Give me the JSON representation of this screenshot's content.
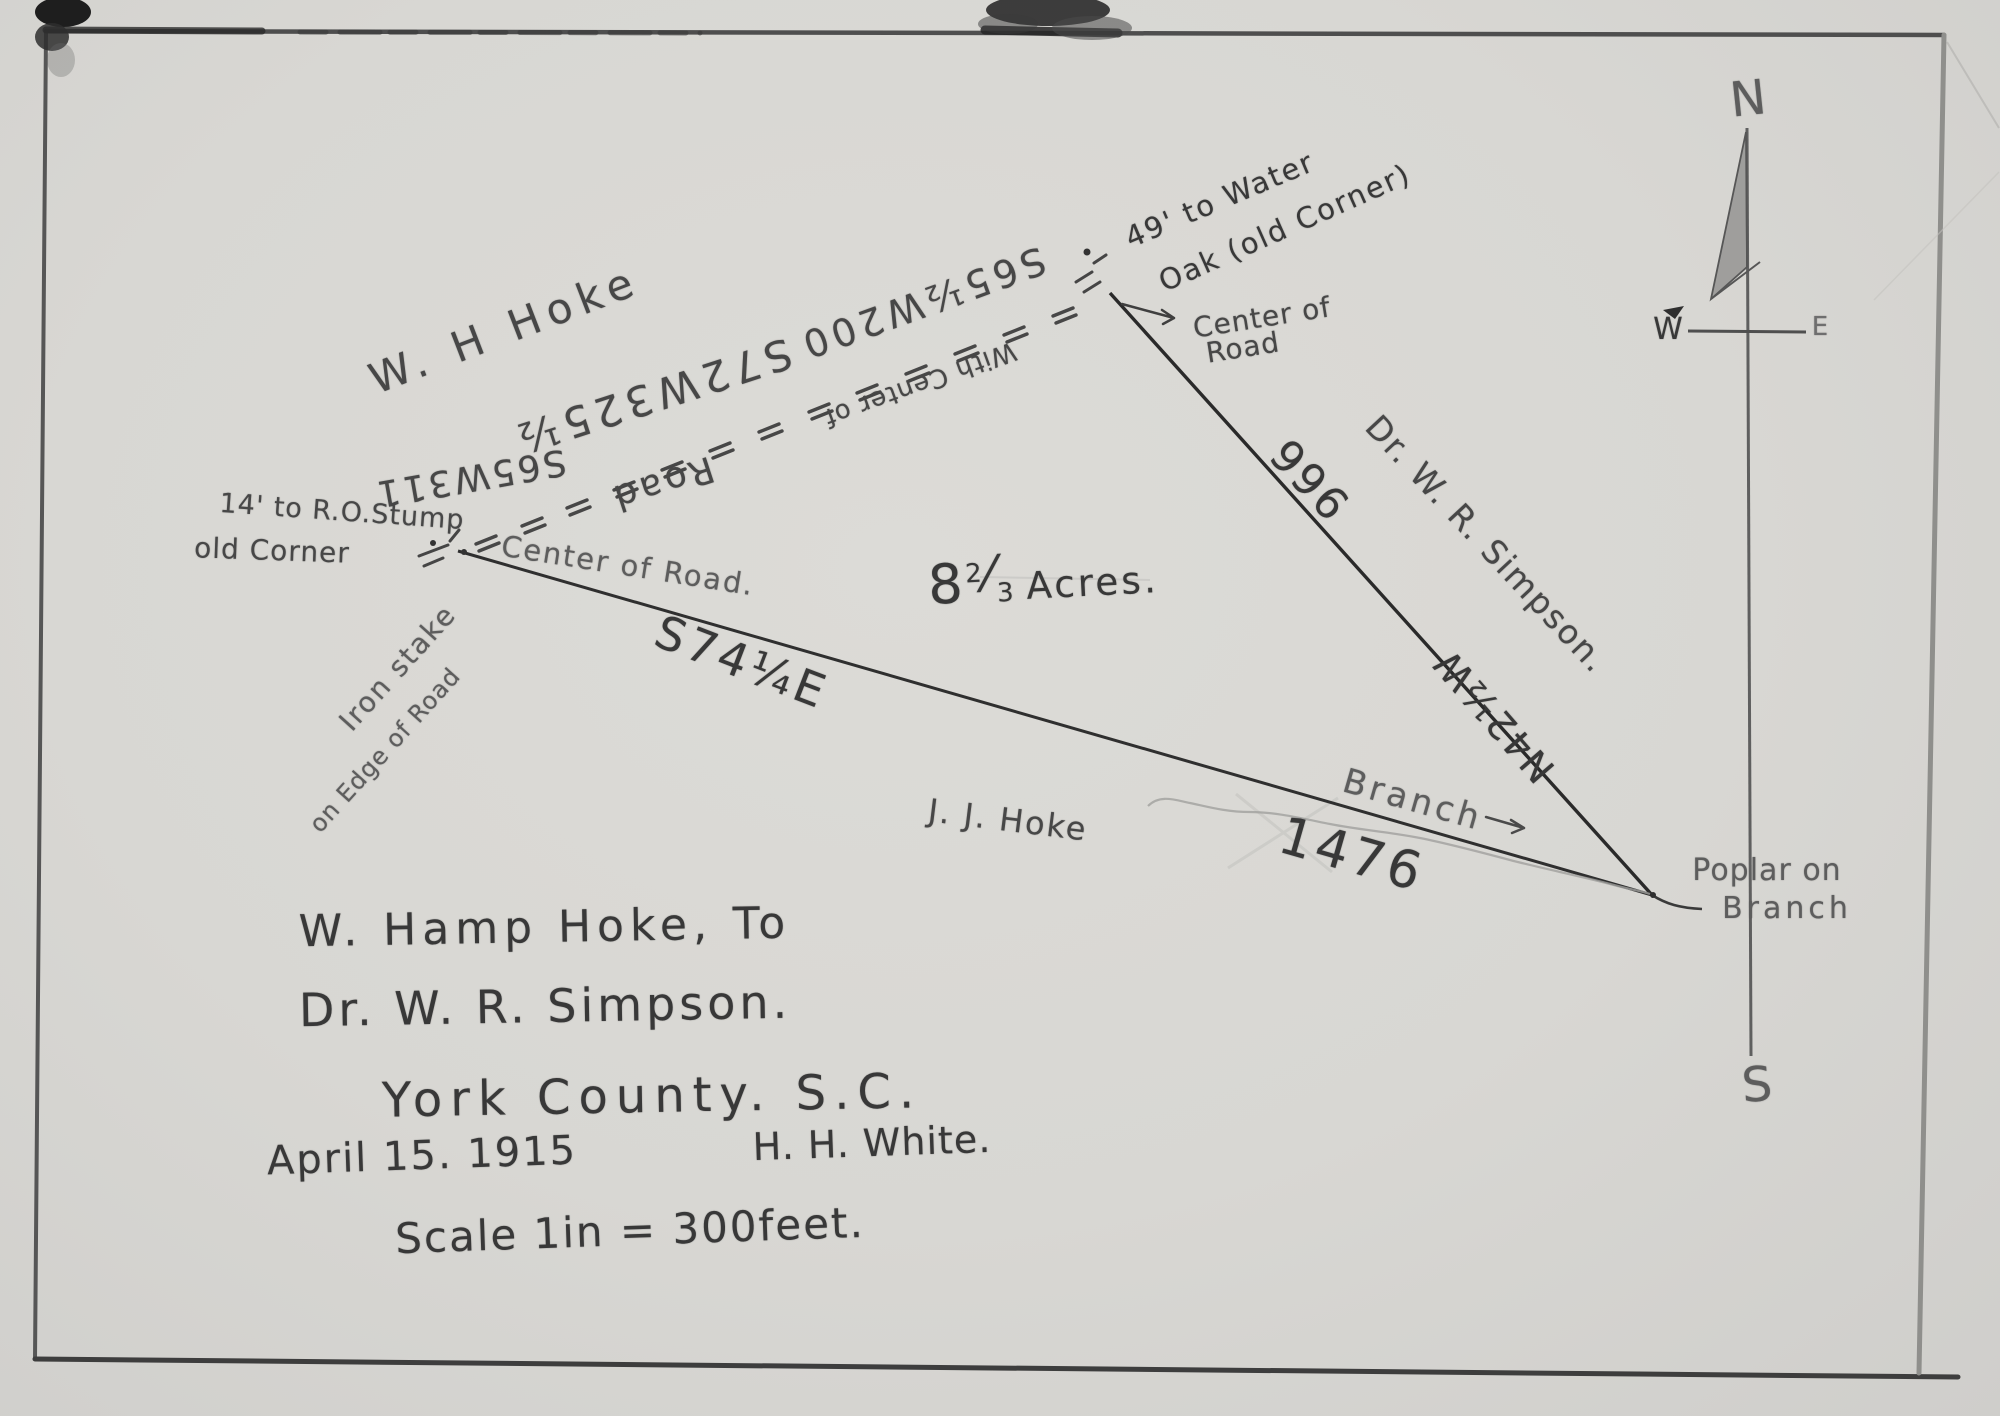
{
  "document": {
    "type": "hand-drawn survey plat",
    "title_block": {
      "grantor_line": "W. Hamp Hoke, To",
      "grantee_line": "Dr. W. R. Simpson.",
      "location_line": "York County. S.C.",
      "date": "April 15. 1915",
      "surveyor": "H. H. White.",
      "scale": "Scale 1in = 300feet."
    },
    "area": {
      "whole": "8",
      "numerator": "2",
      "denominator": "3",
      "unit": "Acres."
    },
    "compass": {
      "north": "N",
      "south": "S",
      "west": "W",
      "east": "E"
    },
    "adjoining_owners": {
      "northwest": "W. H Hoke",
      "south": "J. J. Hoke",
      "northeast": "Dr. W. R. Simpson."
    },
    "road_courses": {
      "course1": "S65W311",
      "course2": "S72W325½",
      "course3": "S65½W200",
      "road_word": "Road",
      "with_center_of": "With Center of"
    },
    "east_line": {
      "bearing": "N42½W",
      "distance": "966"
    },
    "south_line": {
      "bearing": "S74¼E",
      "distance": "1476"
    },
    "west_corner": {
      "tie": "14' to R.O.Stump",
      "old_corner": "old Corner",
      "center_of_road": "Center of Road.",
      "monument_line1": "Iron stake",
      "monument_line2": "on Edge of Road"
    },
    "north_corner": {
      "tie_line1": "49' to Water",
      "tie_line2": "Oak (old Corner)",
      "note_line1": "Center of",
      "note_line2": "Road"
    },
    "southeast_corner": {
      "label_line1": "Poplar on",
      "label_line2": "Branch"
    },
    "stream": {
      "label": "Branch"
    }
  }
}
